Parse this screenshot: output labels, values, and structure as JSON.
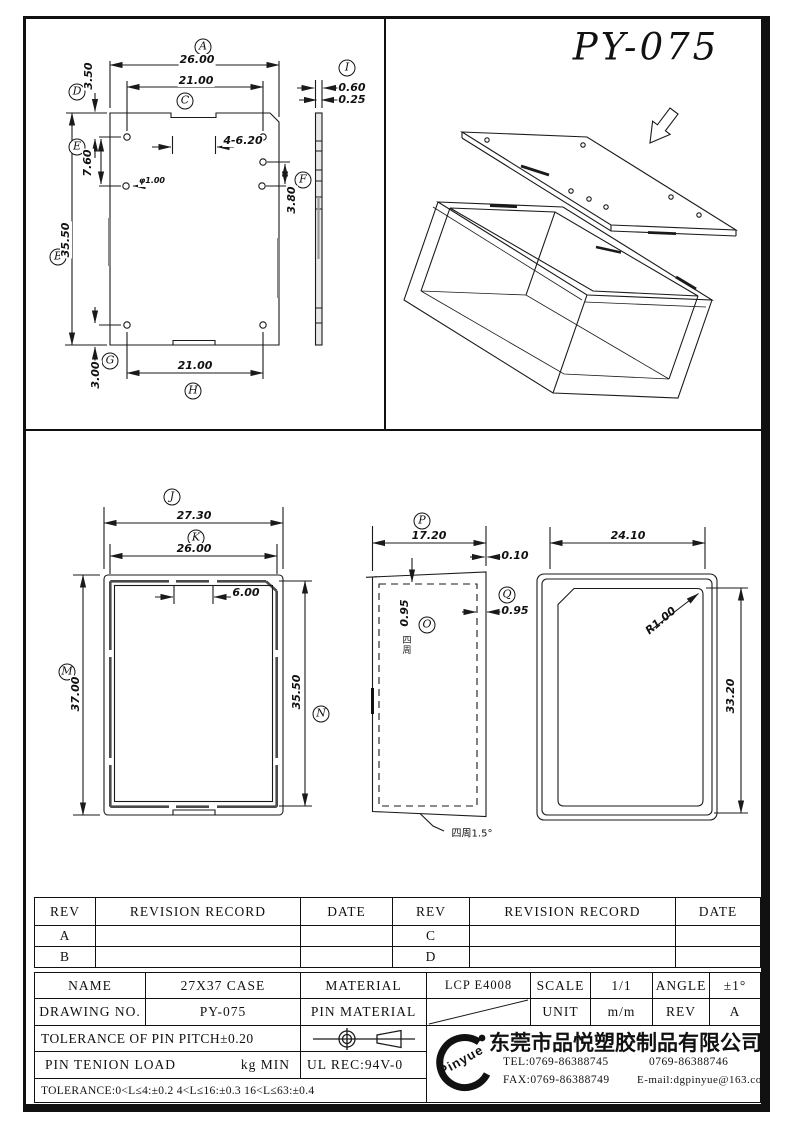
{
  "part_number": "PY-075",
  "balloons": {
    "a": "A",
    "b": "B",
    "c": "C",
    "d": "D",
    "e": "E",
    "f": "F",
    "g": "G",
    "h": "H",
    "i": "I",
    "j": "J",
    "k": "K",
    "m": "M",
    "n": "N",
    "o": "O",
    "p": "P",
    "q": "Q"
  },
  "plate_view": {
    "dim_a": "26.00",
    "dim_c": "21.00",
    "dim_d": "3.50",
    "dim_b": "35.50",
    "dim_e": "7.60",
    "dim_holes": "4-6.20",
    "dim_hole_dia": "φ1.00",
    "dim_f": "3.80",
    "dim_g": "3.00",
    "dim_h": "21.00",
    "dim_i1": "0.60",
    "dim_i2": "0.25"
  },
  "case_front_view": {
    "dim_j": "27.30",
    "dim_k": "26.00",
    "dim_slot": "6.00",
    "dim_m": "37.00",
    "dim_n": "35.50"
  },
  "case_side_view": {
    "dim_p": "17.20",
    "dim_lip": "0.10",
    "dim_q": "0.95",
    "dim_wall": "0.95",
    "wall_note": "四周",
    "draft_note": "四周1.5°"
  },
  "lid_back_view": {
    "dim_width": "24.10",
    "dim_radius": "R1.00",
    "dim_height": "33.20"
  },
  "revision_table": {
    "headers": [
      "REV",
      "REVISION RECORD",
      "DATE",
      "REV",
      "REVISION RECORD",
      "DATE"
    ],
    "rows": [
      [
        "A",
        "",
        "",
        "C",
        "",
        ""
      ],
      [
        "B",
        "",
        "",
        "D",
        "",
        ""
      ]
    ]
  },
  "title_block": {
    "name_label": "NAME",
    "name_value": "27X37 CASE",
    "material_label": "MATERIAL",
    "material_value": "LCP E4008",
    "scale_label": "SCALE",
    "scale_value": "1/1",
    "angle_label": "ANGLE",
    "angle_value": "±1°",
    "drawing_no_label": "DRAWING NO.",
    "drawing_no_value": "PY-075",
    "pin_material_label": "PIN MATERIAL",
    "unit_label": "UNIT",
    "unit_value": "m/m",
    "rev_label": "REV",
    "rev_value": "A",
    "pin_pitch_tolerance": "TOLERANCE OF PIN PITCH±0.20",
    "pin_tension_label": "PIN TENION LOAD",
    "pin_tension_unit": "kg MIN",
    "ul_rec": "UL REC:94V-0",
    "length_tolerance": "TOLERANCE:0<L≤4:±0.2  4<L≤16:±0.3  16<L≤63:±0.4"
  },
  "company": {
    "logo_text": "Pinyue",
    "name": "东莞市品悦塑胶制品有限公司",
    "tel": "TEL:0769-86388745",
    "tel2": "0769-86388746",
    "fax": "FAX:0769-86388749",
    "email": "E-mail:dgpinyue@163.com"
  }
}
